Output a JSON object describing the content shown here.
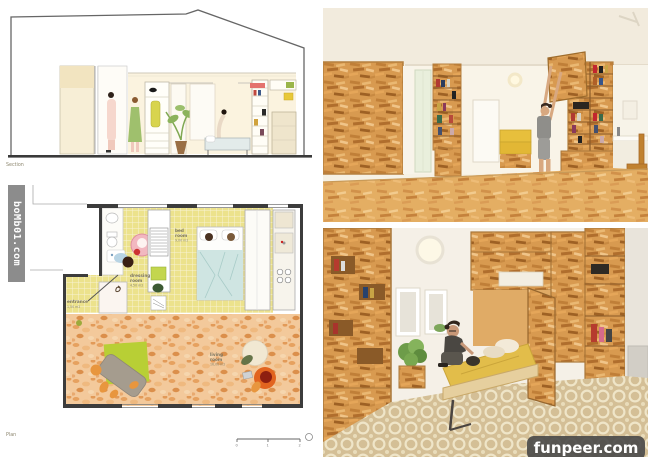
{
  "watermarks": {
    "left_vertical": {
      "text": "boMb01.com"
    },
    "bottom_right": {
      "text": "funpeer.com"
    }
  },
  "drawings": {
    "section": {
      "label": "Section"
    },
    "plan": {
      "label": "Plan",
      "rooms": {
        "bedroom": {
          "line1": "bed",
          "line2": "room",
          "area": "9,00 m2"
        },
        "dressing": {
          "line1": "dressing",
          "line2": "room",
          "area": "4,50 m2"
        },
        "entrance": {
          "line1": "entrance",
          "line2": "",
          "area": "1,50 m2"
        },
        "living": {
          "line1": "living",
          "line2": "room",
          "area": "16,00 m2"
        }
      },
      "scale": {
        "t0": "0",
        "t1": "1",
        "t2": "2"
      }
    }
  },
  "colors": {
    "osb": "#d89a50",
    "osb_floor": "#e4ae63",
    "plan_yellow": "#ece28c",
    "terracotta": "#f3c99b",
    "bedding_yellow": "#e2bd4a",
    "watermark_gray": "#828282",
    "funpeer_bg": "#484848"
  }
}
